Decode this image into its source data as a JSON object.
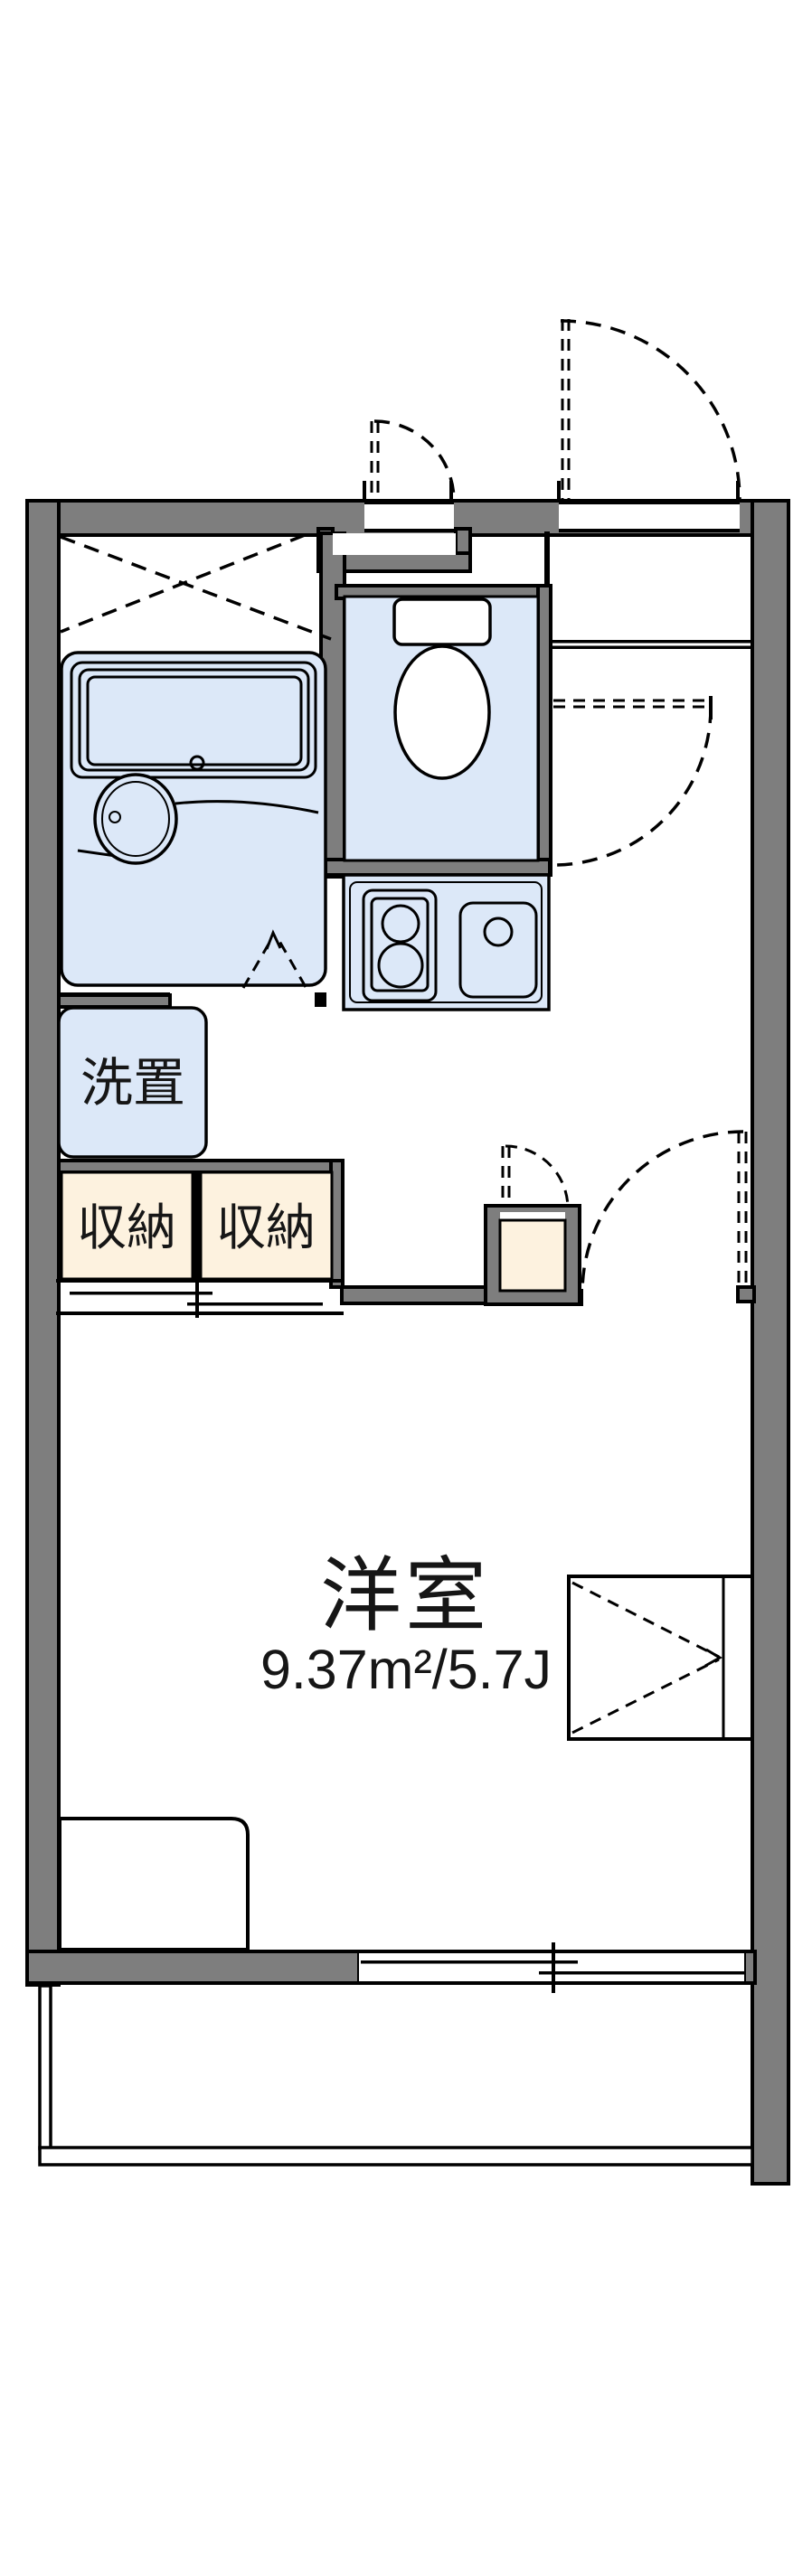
{
  "plan": {
    "rooms": {
      "laundry_label": "洗置",
      "storage_label_1": "収納",
      "storage_label_2": "収納",
      "main_room_label": "洋室",
      "main_room_size": "9.37m²/5.7J"
    },
    "colors": {
      "wall": "#7e7e7e",
      "fixture": "#dce8f8",
      "storage": "#fdf2df",
      "line": "#000000"
    }
  }
}
